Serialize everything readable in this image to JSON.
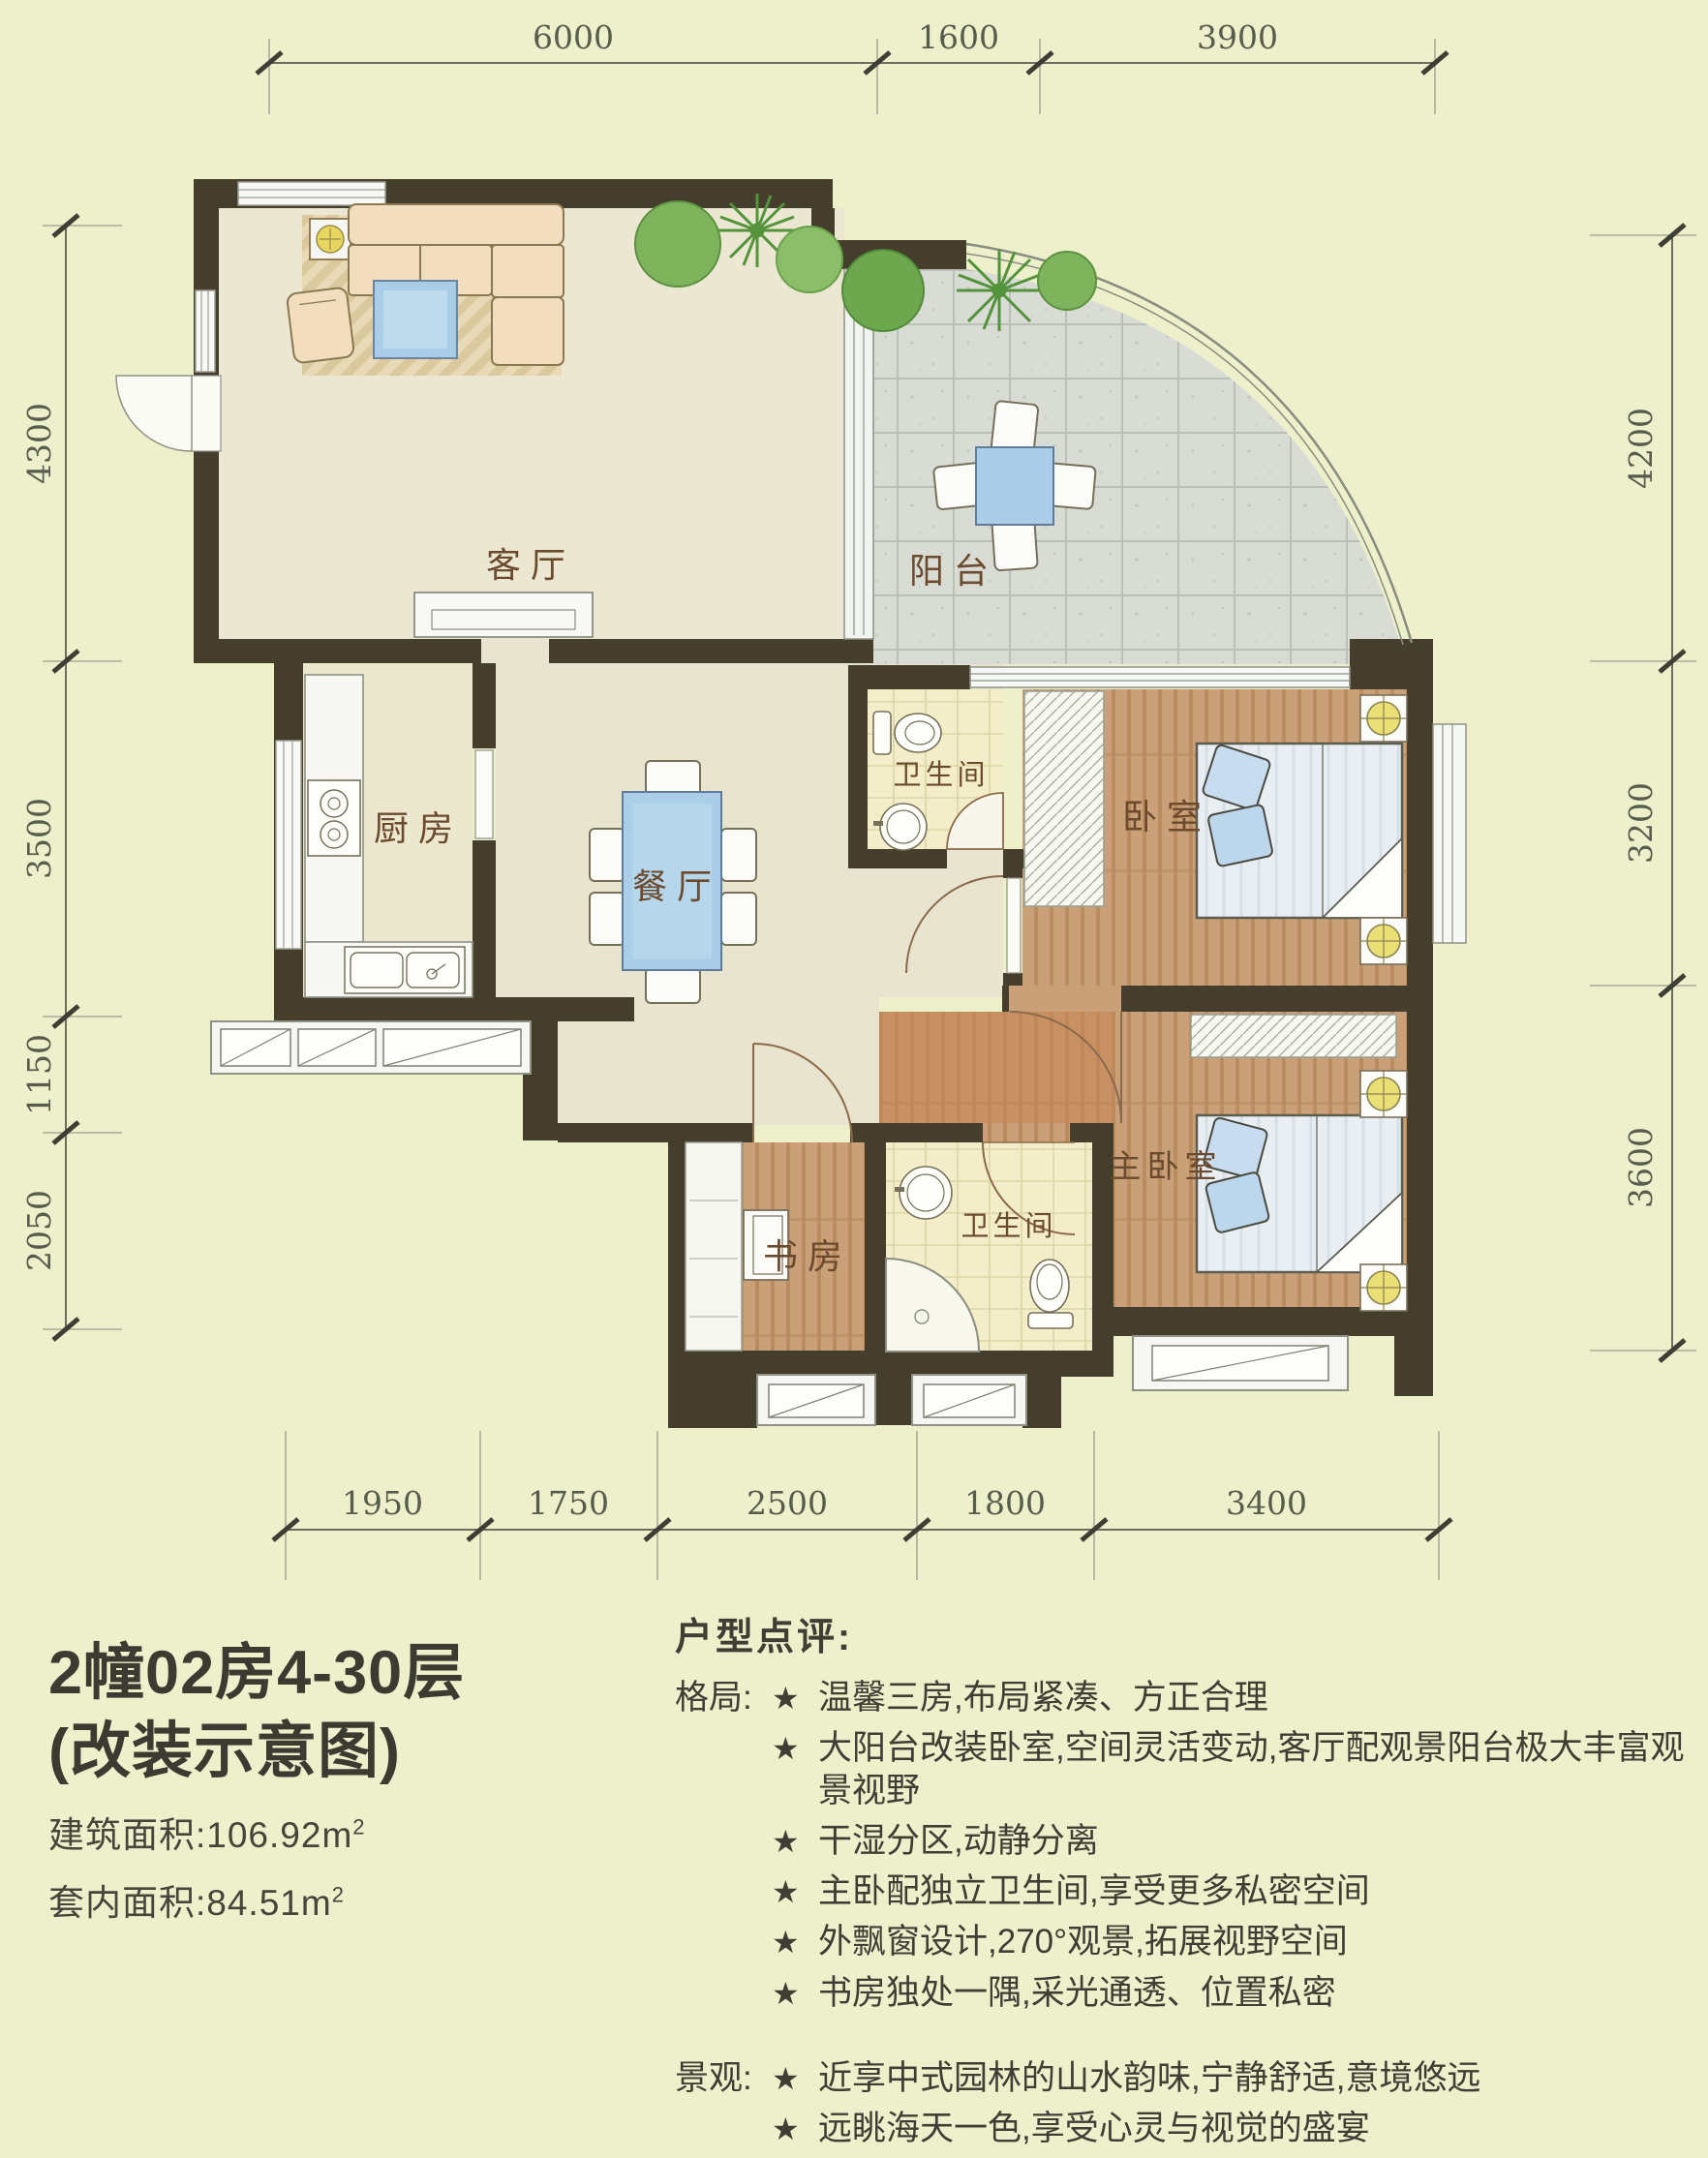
{
  "title_block": {
    "line1": "2幢02房4-30层",
    "line2": "(改装示意图)",
    "area_items": [
      {
        "label": "建筑面积:",
        "value": "106.92m",
        "sup": "2"
      },
      {
        "label": "套内面积:",
        "value": "84.51m",
        "sup": "2"
      }
    ]
  },
  "review": {
    "heading": "户型点评:",
    "star": "★",
    "groups": [
      {
        "label": "格局:",
        "items": [
          "温馨三房,布局紧凑、方正合理",
          "大阳台改装卧室,空间灵活变动,客厅配观景阳台极大丰富观景视野",
          "干湿分区,动静分离",
          "主卧配独立卫生间,享受更多私密空间",
          "外飘窗设计,270°观景,拓展视野空间",
          "书房独处一隅,采光通透、位置私密"
        ]
      },
      {
        "label": "景观:",
        "items": [
          "近享中式园林的山水韵味,宁静舒适,意境悠远",
          "远眺海天一色,享受心灵与视觉的盛宴"
        ]
      }
    ]
  },
  "rooms": {
    "living": "客厅",
    "balcony": "阳台",
    "kitchen": "厨房",
    "dining": "餐厅",
    "bath1": "卫生间",
    "bedroom": "卧室",
    "study": "书房",
    "bath2": "卫生间",
    "master": "主卧室"
  },
  "dims": {
    "top": [
      "6000",
      "1600",
      "3900"
    ],
    "left": [
      "4300",
      "3500",
      "1150",
      "2050"
    ],
    "right": [
      "4200",
      "3200",
      "3600"
    ],
    "bottom": [
      "1950",
      "1750",
      "2500",
      "1800",
      "3400"
    ]
  },
  "colors": {
    "background": "#edf0cb",
    "wall": "#453e2d",
    "wood_floor": "#c9a078",
    "wood_entry": "#c8814f",
    "bath_tile": "#f3eec9",
    "balcony_tile": "#d9dcd4",
    "accent_blue": "#aacee8",
    "furniture_tan": "#f2debe",
    "tree_green": "#6da84e",
    "lamp_yellow": "#eadf74"
  }
}
